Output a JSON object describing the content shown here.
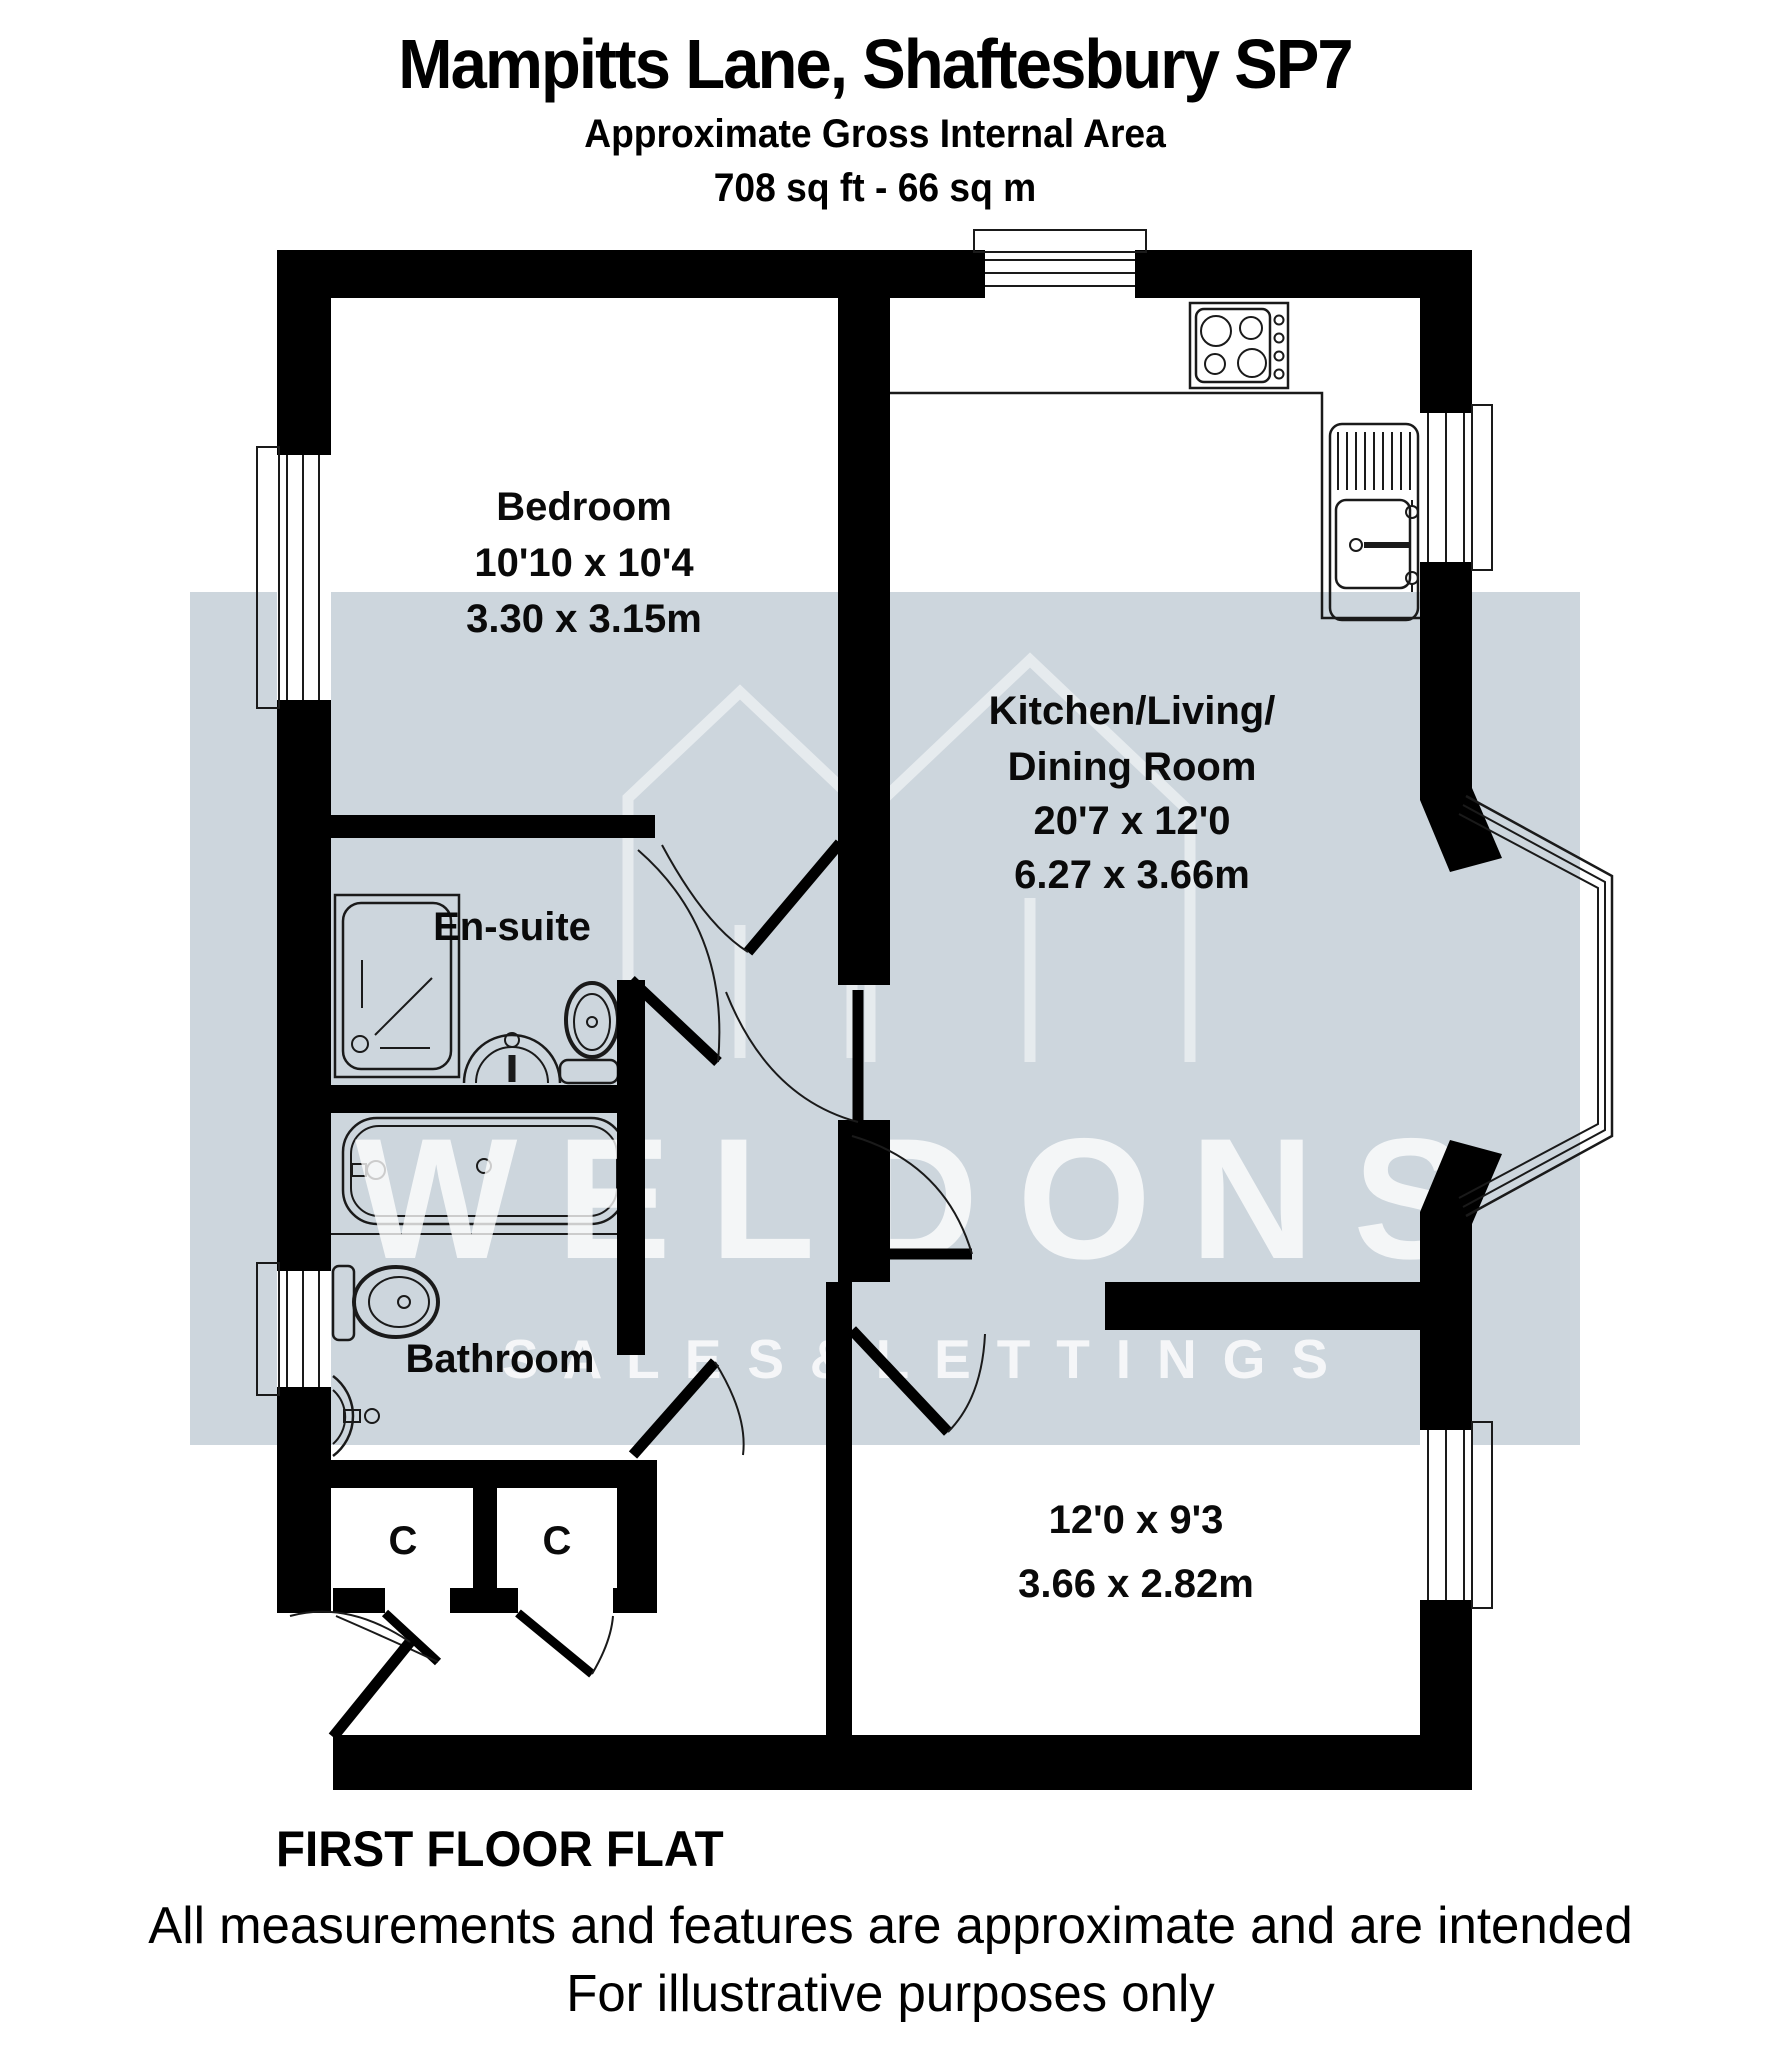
{
  "header": {
    "title": "Mampitts Lane, Shaftesbury SP7",
    "subtitle": "Approximate Gross Internal Area",
    "area": "708 sq ft - 66 sq m"
  },
  "rooms": {
    "bedroom": {
      "name": "Bedroom",
      "imperial": "10'10 x 10'4",
      "metric": "3.30 x 3.15m"
    },
    "kitchen": {
      "name_line1": "Kitchen/Living/",
      "name_line2": "Dining Room",
      "imperial": "20'7 x 12'0",
      "metric": "6.27 x 3.66m"
    },
    "ensuite": {
      "name": "En-suite"
    },
    "bathroom": {
      "name": "Bathroom"
    },
    "bedroom2": {
      "imperial": "12'0 x 9'3",
      "metric": "3.66 x 2.82m"
    },
    "cupboard_left": {
      "label": "C"
    },
    "cupboard_right": {
      "label": "C"
    }
  },
  "watermark": {
    "brand": "WELDONS",
    "tagline": "S A L E S   &   L E T T I N G S"
  },
  "footer": {
    "floor": "FIRST FLOOR FLAT",
    "disclaimer1": "All measurements and features are approximate and are intended",
    "disclaimer2": "For illustrative purposes only"
  },
  "colors": {
    "wall": "#000000",
    "band": "#cdd6dd",
    "line": "#1a1a1a",
    "watermark": "#ffffff"
  }
}
